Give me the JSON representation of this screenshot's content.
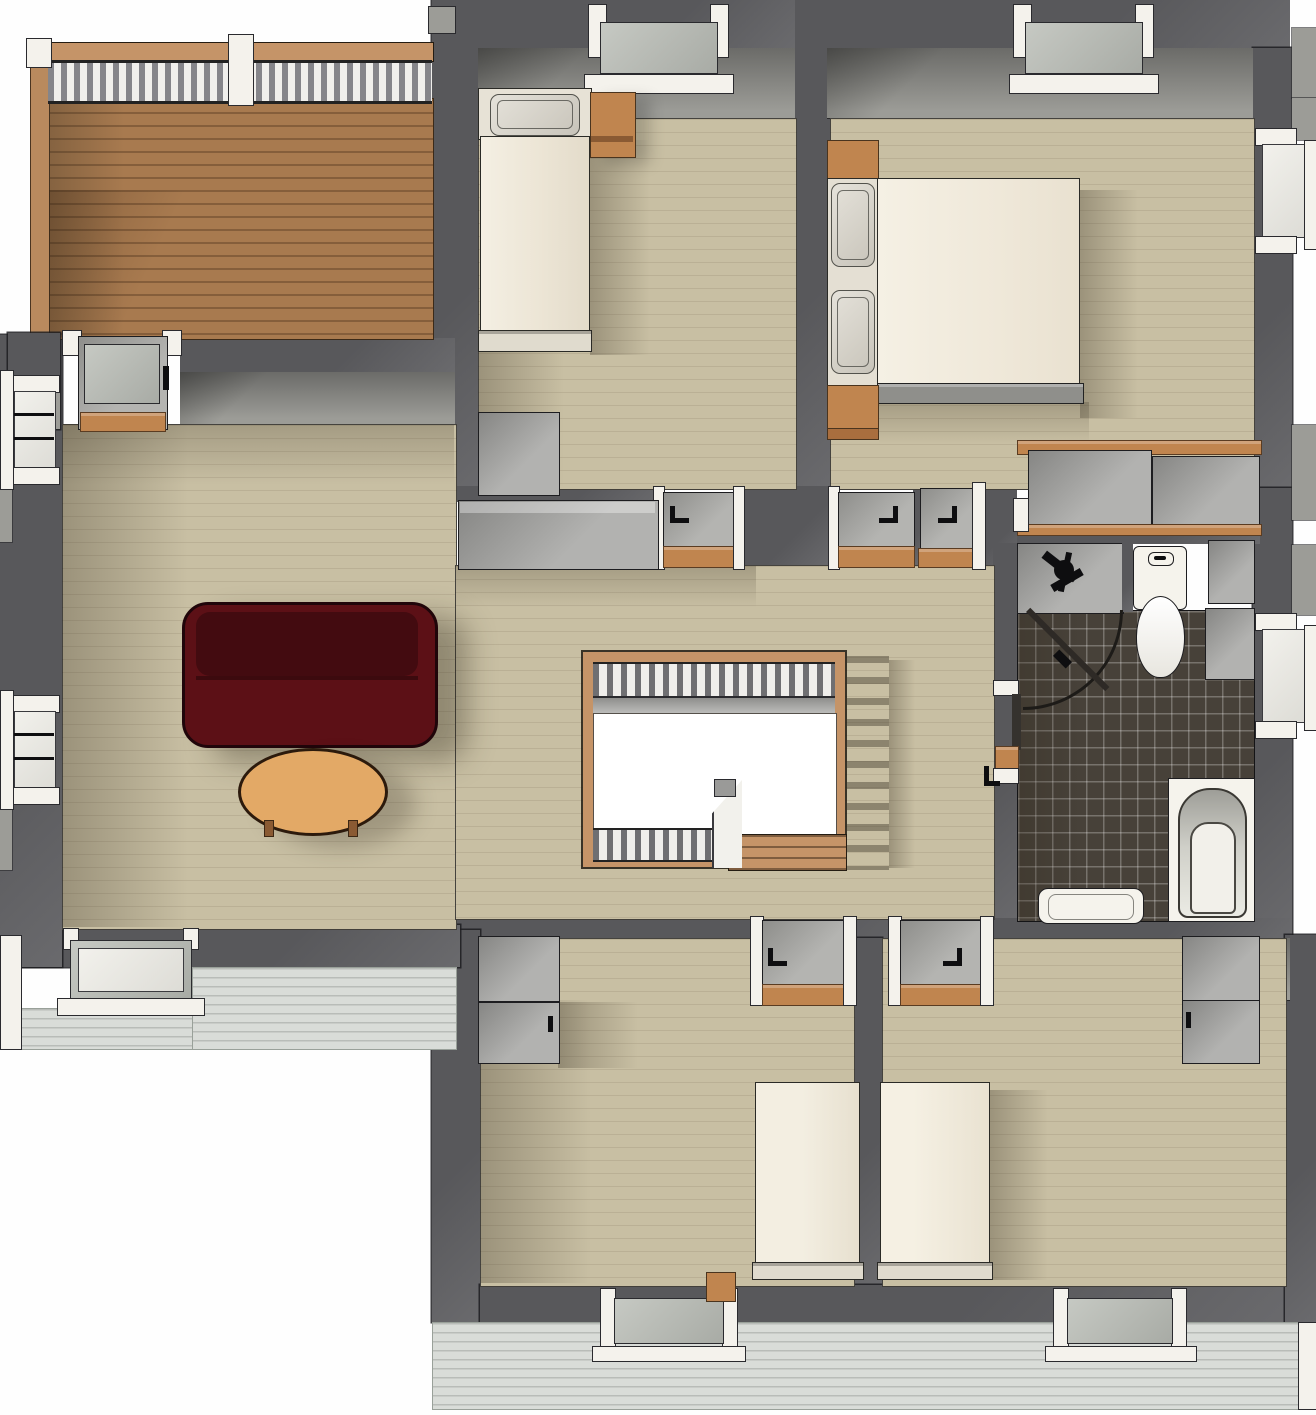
{
  "meta": {
    "view": "rendered-3d-floor-plan-top-view",
    "storey": "upper-floor"
  },
  "palette": {
    "wall": "#58585b",
    "wall_lt": "#6a6a6d",
    "face_dark": "#6b6b68",
    "face_light": "#9c9c97",
    "floor": "#c8bfa3",
    "tile": "#474139",
    "trim": "#f4f2ec",
    "cab": "#b2b2b0",
    "cab_dark": "#868684",
    "wood": "#c0854f",
    "deck": "#a87a4f",
    "deck_edge": "#b98a5e",
    "rail_wood": "#c59468",
    "siding": "#d9dcd8",
    "fixture": "#f5f3ec",
    "sofa": "#5c1016",
    "sofa_back": "#430b10",
    "table": "#e3a966"
  },
  "scene": {
    "deck": {
      "features": [
        "balustrade-railing",
        "balusters",
        "white-posts",
        "wood-boards",
        "sliding-glass-door"
      ]
    },
    "rooms": [
      {
        "id": "bedroom-top-left",
        "furniture": [
          "single-bed",
          "pillow",
          "nightstand",
          "wardrobe"
        ],
        "openings": [
          "window-top",
          "door-to-hallway"
        ]
      },
      {
        "id": "bedroom-top-right",
        "furniture": [
          "double-bed",
          "pillow",
          "pillow",
          "nightstand",
          "nightstand",
          "sliding-door-closet"
        ],
        "openings": [
          "window-top",
          "window-right",
          "door-to-hallway",
          "door-to-hallway"
        ]
      },
      {
        "id": "living-room",
        "furniture": [
          "red-sofa",
          "oval-coffee-table"
        ],
        "openings": [
          "deck-door",
          "window-left-upper",
          "window-left-lower",
          "window-south"
        ]
      },
      {
        "id": "hallway",
        "furniture": [
          "closet-unit"
        ],
        "openings": [
          "stairwell-opening"
        ]
      },
      {
        "id": "bathroom",
        "furniture": [
          "vanity-counter-with-faucet",
          "toilet",
          "side-cabinet",
          "side-counter",
          "corner-shower-enclosure",
          "shower-tray",
          "bathtub"
        ],
        "openings": [
          "door-west",
          "window-right"
        ]
      },
      {
        "id": "bedroom-bottom-left",
        "furniture": [
          "bed",
          "upper-cabinet",
          "lower-cabinet",
          "small-nightstand"
        ],
        "openings": [
          "door-north",
          "window-south"
        ]
      },
      {
        "id": "bedroom-bottom-right",
        "furniture": [
          "bed",
          "upper-cabinet",
          "lower-cabinet"
        ],
        "openings": [
          "door-north",
          "window-south"
        ]
      }
    ],
    "stairs": {
      "features": [
        "wood-frame",
        "gray-balusters",
        "open-void",
        "treads",
        "newel-landing"
      ]
    }
  }
}
